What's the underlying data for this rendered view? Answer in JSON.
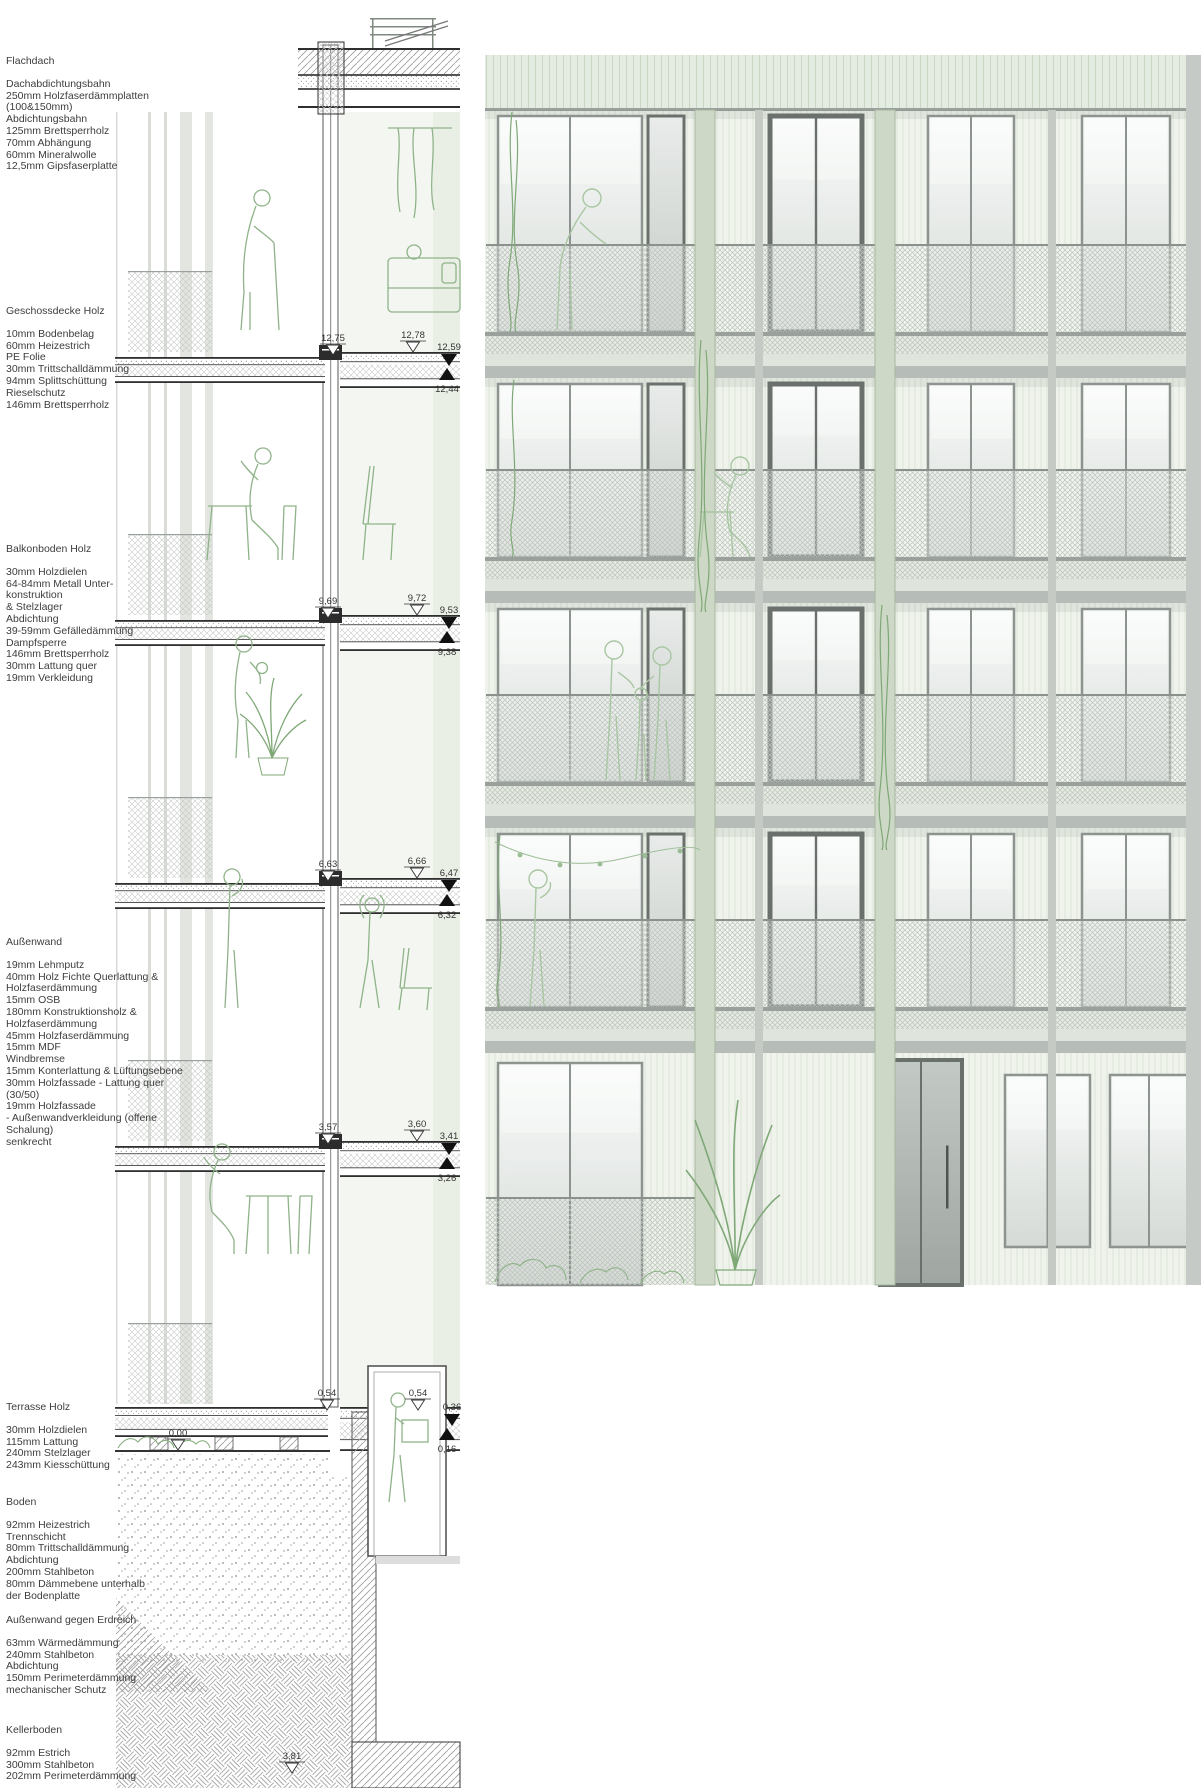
{
  "annotation_blocks": [
    {
      "title": "Flachdach",
      "lines": [
        "Dachabdichtungsbahn",
        "250mm Holzfaserdämmplatten",
        "(100&150mm)",
        "Abdichtungsbahn",
        "125mm Brettsperrholz",
        "70mm Abhängung",
        "60mm Mineralwolle",
        "12,5mm Gipsfaserplatte"
      ]
    },
    {
      "title": "Geschossdecke Holz",
      "lines": [
        "10mm Bodenbelag",
        "60mm Heizestrich",
        "PE Folie",
        "30mm Trittschalldämmung",
        "94mm Splittschüttung",
        "Rieselschutz",
        "146mm Brettsperrholz"
      ]
    },
    {
      "title": "Balkonboden Holz",
      "lines": [
        "30mm Holzdielen",
        "64-84mm Metall Unter-",
        "konstruktion",
        "& Stelzlager",
        "Abdichtung",
        "39-59mm Gefälledämmung",
        "Dampfsperre",
        "146mm Brettsperrholz",
        "30mm  Lattung quer",
        "19mm Verkleidung"
      ]
    },
    {
      "title": "Außenwand",
      "lines": [
        "19mm Lehmputz",
        "40mm Holz Fichte Querlattung &",
        "Holzfaserdämmung",
        "15mm OSB",
        "180mm Konstruktionsholz &",
        "Holzfaserdämmung",
        "45mm Holzfaserdämmung",
        "15mm MDF",
        "Windbremse",
        "15mm Konterlattung & Lüftungsebene",
        "30mm Holzfassade - Lattung quer (30/50)",
        "19mm Holzfassade",
        "- Außenwandverkleidung (offene Schalung)",
        "senkrecht"
      ]
    },
    {
      "title": "Terrasse Holz",
      "lines": [
        "30mm Holzdielen",
        "115mm Lattung",
        "240mm Stelzlager",
        "243mm Kiesschüttung"
      ]
    },
    {
      "title": "Boden",
      "lines": [
        "92mm Heizestrich",
        "Trennschicht",
        "80mm Trittschalldämmung",
        "Abdichtung",
        "200mm Stahlbeton",
        "80mm Dämmebene unterhalb",
        "der Bodenplatte"
      ]
    },
    {
      "title": "Außenwand gegen Erdreich",
      "lines": [
        "63mm Wärmedämmung",
        "240mm Stahlbeton",
        "Abdichtung",
        "150mm Perimeterdämmung",
        "mechanischer Schutz"
      ]
    },
    {
      "title": "Kellerboden",
      "lines": [
        "92mm Estrich",
        "300mm Stahlbeton",
        "202mm Perimeterdämmung"
      ]
    }
  ],
  "section": {
    "slab_tops": [
      352,
      615,
      878,
      1141
    ],
    "mesh_ys": [
      271,
      534,
      797,
      1060,
      1323
    ],
    "markers": [
      {
        "label": "12,75",
        "x": 333,
        "y": 341,
        "t": "open"
      },
      {
        "label": "12,78",
        "x": 413,
        "y": 338,
        "t": "open"
      },
      {
        "label": "12,59",
        "x": 449,
        "y": 350,
        "t": "fd"
      },
      {
        "label": "12,44",
        "x": 447,
        "y": 368,
        "t": "fu"
      },
      {
        "label": "9,69",
        "x": 328,
        "y": 604,
        "t": "open"
      },
      {
        "label": "9,72",
        "x": 417,
        "y": 601,
        "t": "open"
      },
      {
        "label": "9,53",
        "x": 449,
        "y": 613,
        "t": "fd"
      },
      {
        "label": "9,38",
        "x": 447,
        "y": 631,
        "t": "fu"
      },
      {
        "label": "6,63",
        "x": 328,
        "y": 867,
        "t": "open"
      },
      {
        "label": "6,66",
        "x": 417,
        "y": 864,
        "t": "open"
      },
      {
        "label": "6,47",
        "x": 449,
        "y": 876,
        "t": "fd"
      },
      {
        "label": "6,32",
        "x": 447,
        "y": 894,
        "t": "fu"
      },
      {
        "label": "3,57",
        "x": 328,
        "y": 1130,
        "t": "open"
      },
      {
        "label": "3,60",
        "x": 417,
        "y": 1127,
        "t": "open"
      },
      {
        "label": "3,41",
        "x": 449,
        "y": 1139,
        "t": "fd"
      },
      {
        "label": "3,26",
        "x": 447,
        "y": 1157,
        "t": "fu"
      },
      {
        "label": "0,54",
        "x": 327,
        "y": 1396,
        "t": "open"
      },
      {
        "label": "0,54",
        "x": 418,
        "y": 1396,
        "t": "open"
      },
      {
        "label": "0,36",
        "x": 452,
        "y": 1410,
        "t": "fd"
      },
      {
        "label": "0,16",
        "x": 447,
        "y": 1428,
        "t": "fu"
      },
      {
        "label": "0,00",
        "x": 178,
        "y": 1436,
        "t": "open"
      },
      {
        "label": "3,81",
        "x": 292,
        "y": 1759,
        "t": "open"
      }
    ]
  },
  "facade": {
    "x": 485,
    "w": 716,
    "top": 55,
    "soffit_h": 55,
    "bottom": 1285,
    "floor_tops": [
      110,
      378,
      603,
      828,
      1053
    ],
    "band_tops": [
      332,
      557,
      782,
      1007
    ],
    "mesh_h": 88,
    "windows": [
      [
        498,
        144,
        "gray2"
      ],
      [
        648,
        36,
        "dark1"
      ],
      [
        770,
        92,
        "dark2"
      ],
      [
        928,
        86,
        "gray2"
      ],
      [
        1082,
        88,
        "gray2"
      ]
    ],
    "ground_windows": [
      [
        498,
        144,
        "gray2",
        1063,
        222
      ],
      [
        880,
        82,
        "door",
        1060,
        225
      ],
      [
        1005,
        85,
        "gray2",
        1075,
        172
      ],
      [
        1110,
        78,
        "gray2",
        1075,
        172
      ]
    ],
    "columns": [
      695,
      875
    ],
    "posts": [
      755,
      1048
    ]
  },
  "colors": {
    "wall": "#eff3ec",
    "soffit": "#e4ebe0",
    "band_deck": "#e6ebe2",
    "band_mid": "#dfe5dc",
    "band_soffit": "#b6bcb7",
    "frame_gray": "#8d938f",
    "frame_dark": "#6a706c",
    "column_green": "#cdd8c6",
    "column_edge": "#a8b8a0",
    "sketch_green": "#8fb389",
    "plant_green": "#7da877",
    "ink": "#3d3d3d"
  }
}
